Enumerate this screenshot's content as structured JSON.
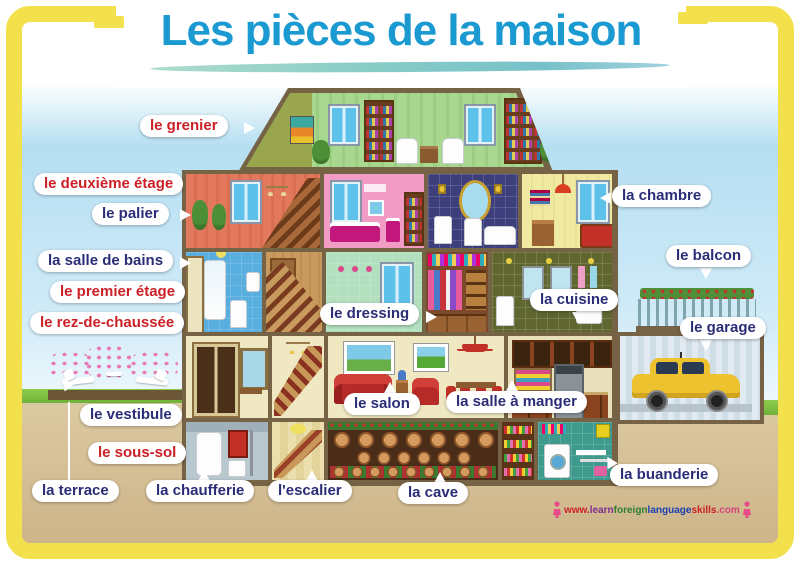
{
  "poster": {
    "title": "Les pièces de la maison"
  },
  "colors": {
    "title_blue": "#1b9ad2",
    "label_red": "#cc2027",
    "label_navy": "#2b2d77",
    "frame_yellow": "#f2e14c"
  },
  "labels": [
    {
      "id": "grenier",
      "text": "le grenier",
      "style": "red"
    },
    {
      "id": "deuxieme-etage",
      "text": "le deuxième étage",
      "style": "red"
    },
    {
      "id": "palier",
      "text": "le palier",
      "style": "navy"
    },
    {
      "id": "salle-de-bains",
      "text": "la salle de bains",
      "style": "navy"
    },
    {
      "id": "premier-etage",
      "text": "le premier étage",
      "style": "red"
    },
    {
      "id": "rez-de-chaussee",
      "text": "le rez-de-chaussée",
      "style": "red"
    },
    {
      "id": "vestibule",
      "text": "le vestibule",
      "style": "navy"
    },
    {
      "id": "sous-sol",
      "text": "le sous-sol",
      "style": "red"
    },
    {
      "id": "terrace",
      "text": "la terrace",
      "style": "navy"
    },
    {
      "id": "chaufferie",
      "text": "la chaufferie",
      "style": "navy"
    },
    {
      "id": "escalier",
      "text": "l'escalier",
      "style": "navy"
    },
    {
      "id": "cave",
      "text": "la cave",
      "style": "navy"
    },
    {
      "id": "salon",
      "text": "le salon",
      "style": "navy"
    },
    {
      "id": "salle-a-manger",
      "text": "la salle à manger",
      "style": "navy"
    },
    {
      "id": "dressing",
      "text": "le dressing",
      "style": "navy"
    },
    {
      "id": "cuisine",
      "text": "la cuisine",
      "style": "navy"
    },
    {
      "id": "chambre",
      "text": "la chambre",
      "style": "navy"
    },
    {
      "id": "balcon",
      "text": "le balcon",
      "style": "navy"
    },
    {
      "id": "garage",
      "text": "le garage",
      "style": "navy"
    },
    {
      "id": "buanderie",
      "text": "la buanderie",
      "style": "navy"
    }
  ],
  "watermark": {
    "segments": [
      {
        "text": "www.",
        "color": "#cc2027"
      },
      {
        "text": "learn",
        "color": "#7b2d8e"
      },
      {
        "text": "foreign",
        "color": "#2e7d32"
      },
      {
        "text": "language",
        "color": "#1a3fb0"
      },
      {
        "text": "skills",
        "color": "#cc2027"
      },
      {
        "text": ".com",
        "color": "#d4447c"
      }
    ]
  }
}
